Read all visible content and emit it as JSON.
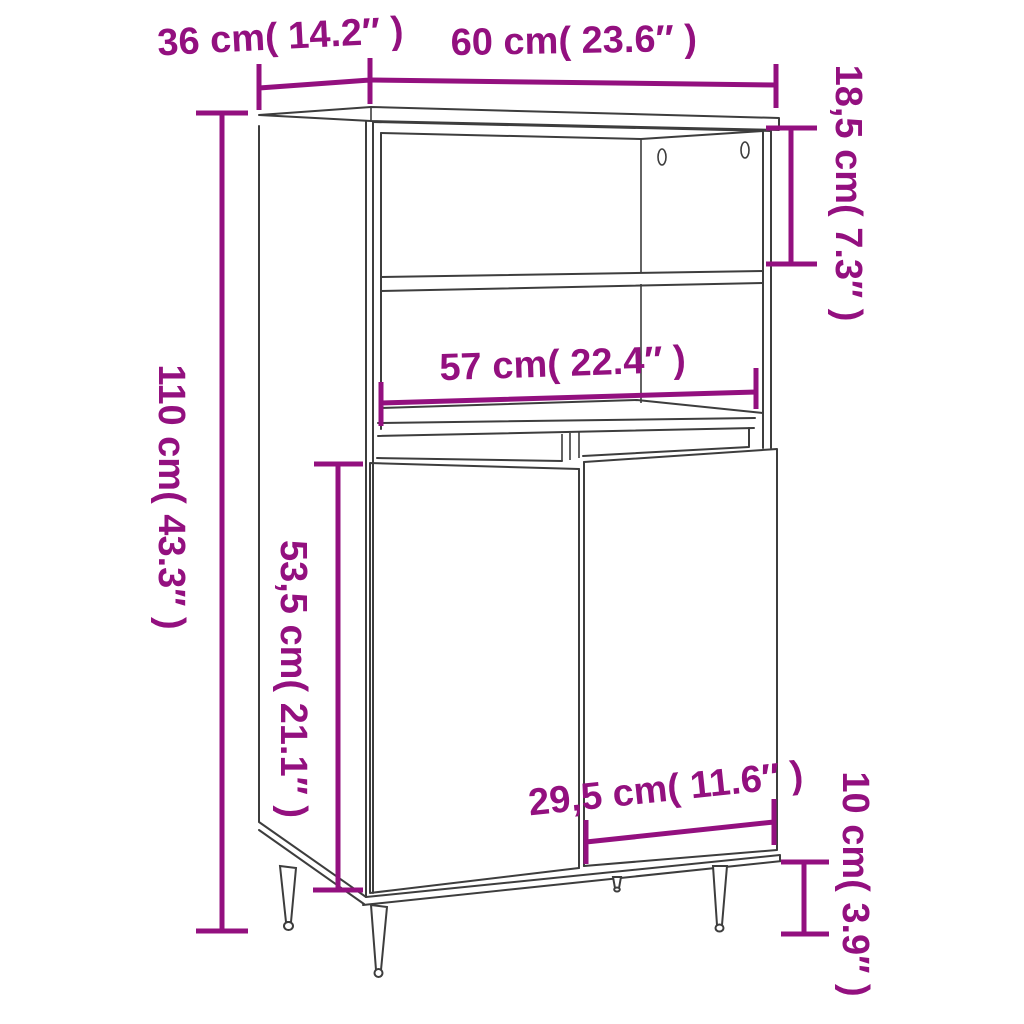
{
  "diagram": {
    "title": "highboard-dimension-diagram",
    "product": "highboard cabinet with two doors, open shelves and tapered legs",
    "colors": {
      "accent": "#93107f",
      "line": "#3d3d3d",
      "background": "#ffffff"
    },
    "back_panel_screw_holes": 2,
    "dimensions": {
      "depth": {
        "label": "36 cm( 14.2″ )",
        "cm": 36,
        "inch": 14.2
      },
      "width": {
        "label": "60 cm( 23.6″ )",
        "cm": 60,
        "inch": 23.6
      },
      "top_section_height": {
        "label": "18,5 cm( 7.3″ )",
        "cm": 18.5,
        "inch": 7.3
      },
      "total_height": {
        "label": "110 cm( 43.3″ )",
        "cm": 110,
        "inch": 43.3
      },
      "inner_width": {
        "label": "57 cm( 22.4″ )",
        "cm": 57,
        "inch": 22.4
      },
      "door_height": {
        "label": "53,5 cm( 21.1″ )",
        "cm": 53.5,
        "inch": 21.1
      },
      "door_width": {
        "label": "29,5 cm( 11.6″ )",
        "cm": 29.5,
        "inch": 11.6
      },
      "leg_height": {
        "label": "10 cm( 3.9″ )",
        "cm": 10,
        "inch": 3.9
      }
    }
  }
}
